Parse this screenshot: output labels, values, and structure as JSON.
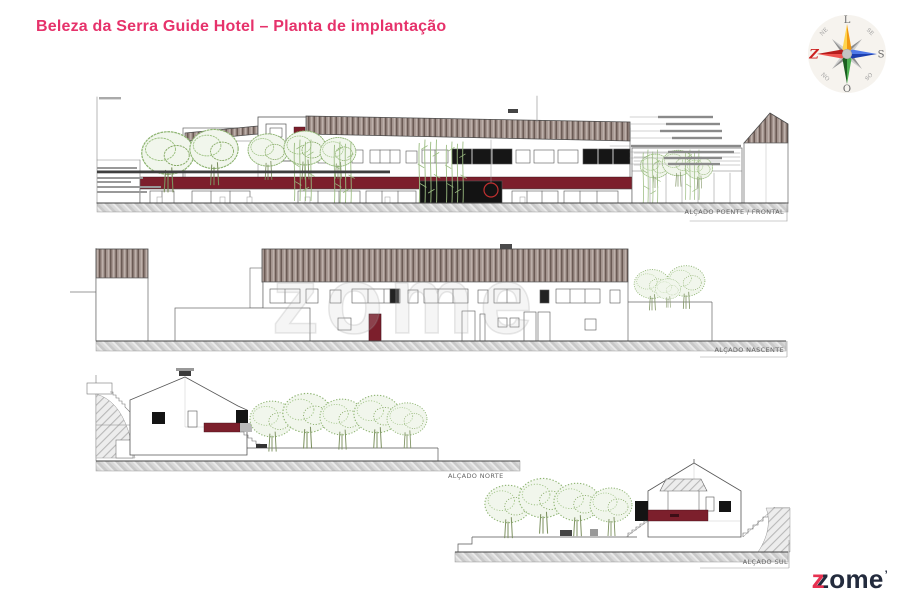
{
  "page": {
    "title": "Beleza da Serra Guide Hotel – Planta de implantação"
  },
  "drawing": {
    "watermark": "zome",
    "elevation_labels": {
      "poente": "ALÇADO POENTE / FRONTAL",
      "nascente": "ALÇADO NASCENTE",
      "norte": "ALÇADO NORTE",
      "sul": "ALÇADO SUL"
    }
  },
  "compass": {
    "top": "L",
    "right": "S",
    "bottom": "O",
    "left": "Z",
    "top_left": "NE",
    "top_right": "SE",
    "bottom_right": "SO",
    "bottom_left": "NO"
  },
  "logo": {
    "z_overlay": "z",
    "text": "zome",
    "mark": "’"
  },
  "colors": {
    "accent_pink": "#e6326b",
    "maroon": "#7c1f2c",
    "roof_taupe": "#a3938d",
    "tree_green": "#8fb573",
    "logo_navy": "#232b3d",
    "logo_red": "#e73150",
    "compass_red": "#cc2020"
  }
}
